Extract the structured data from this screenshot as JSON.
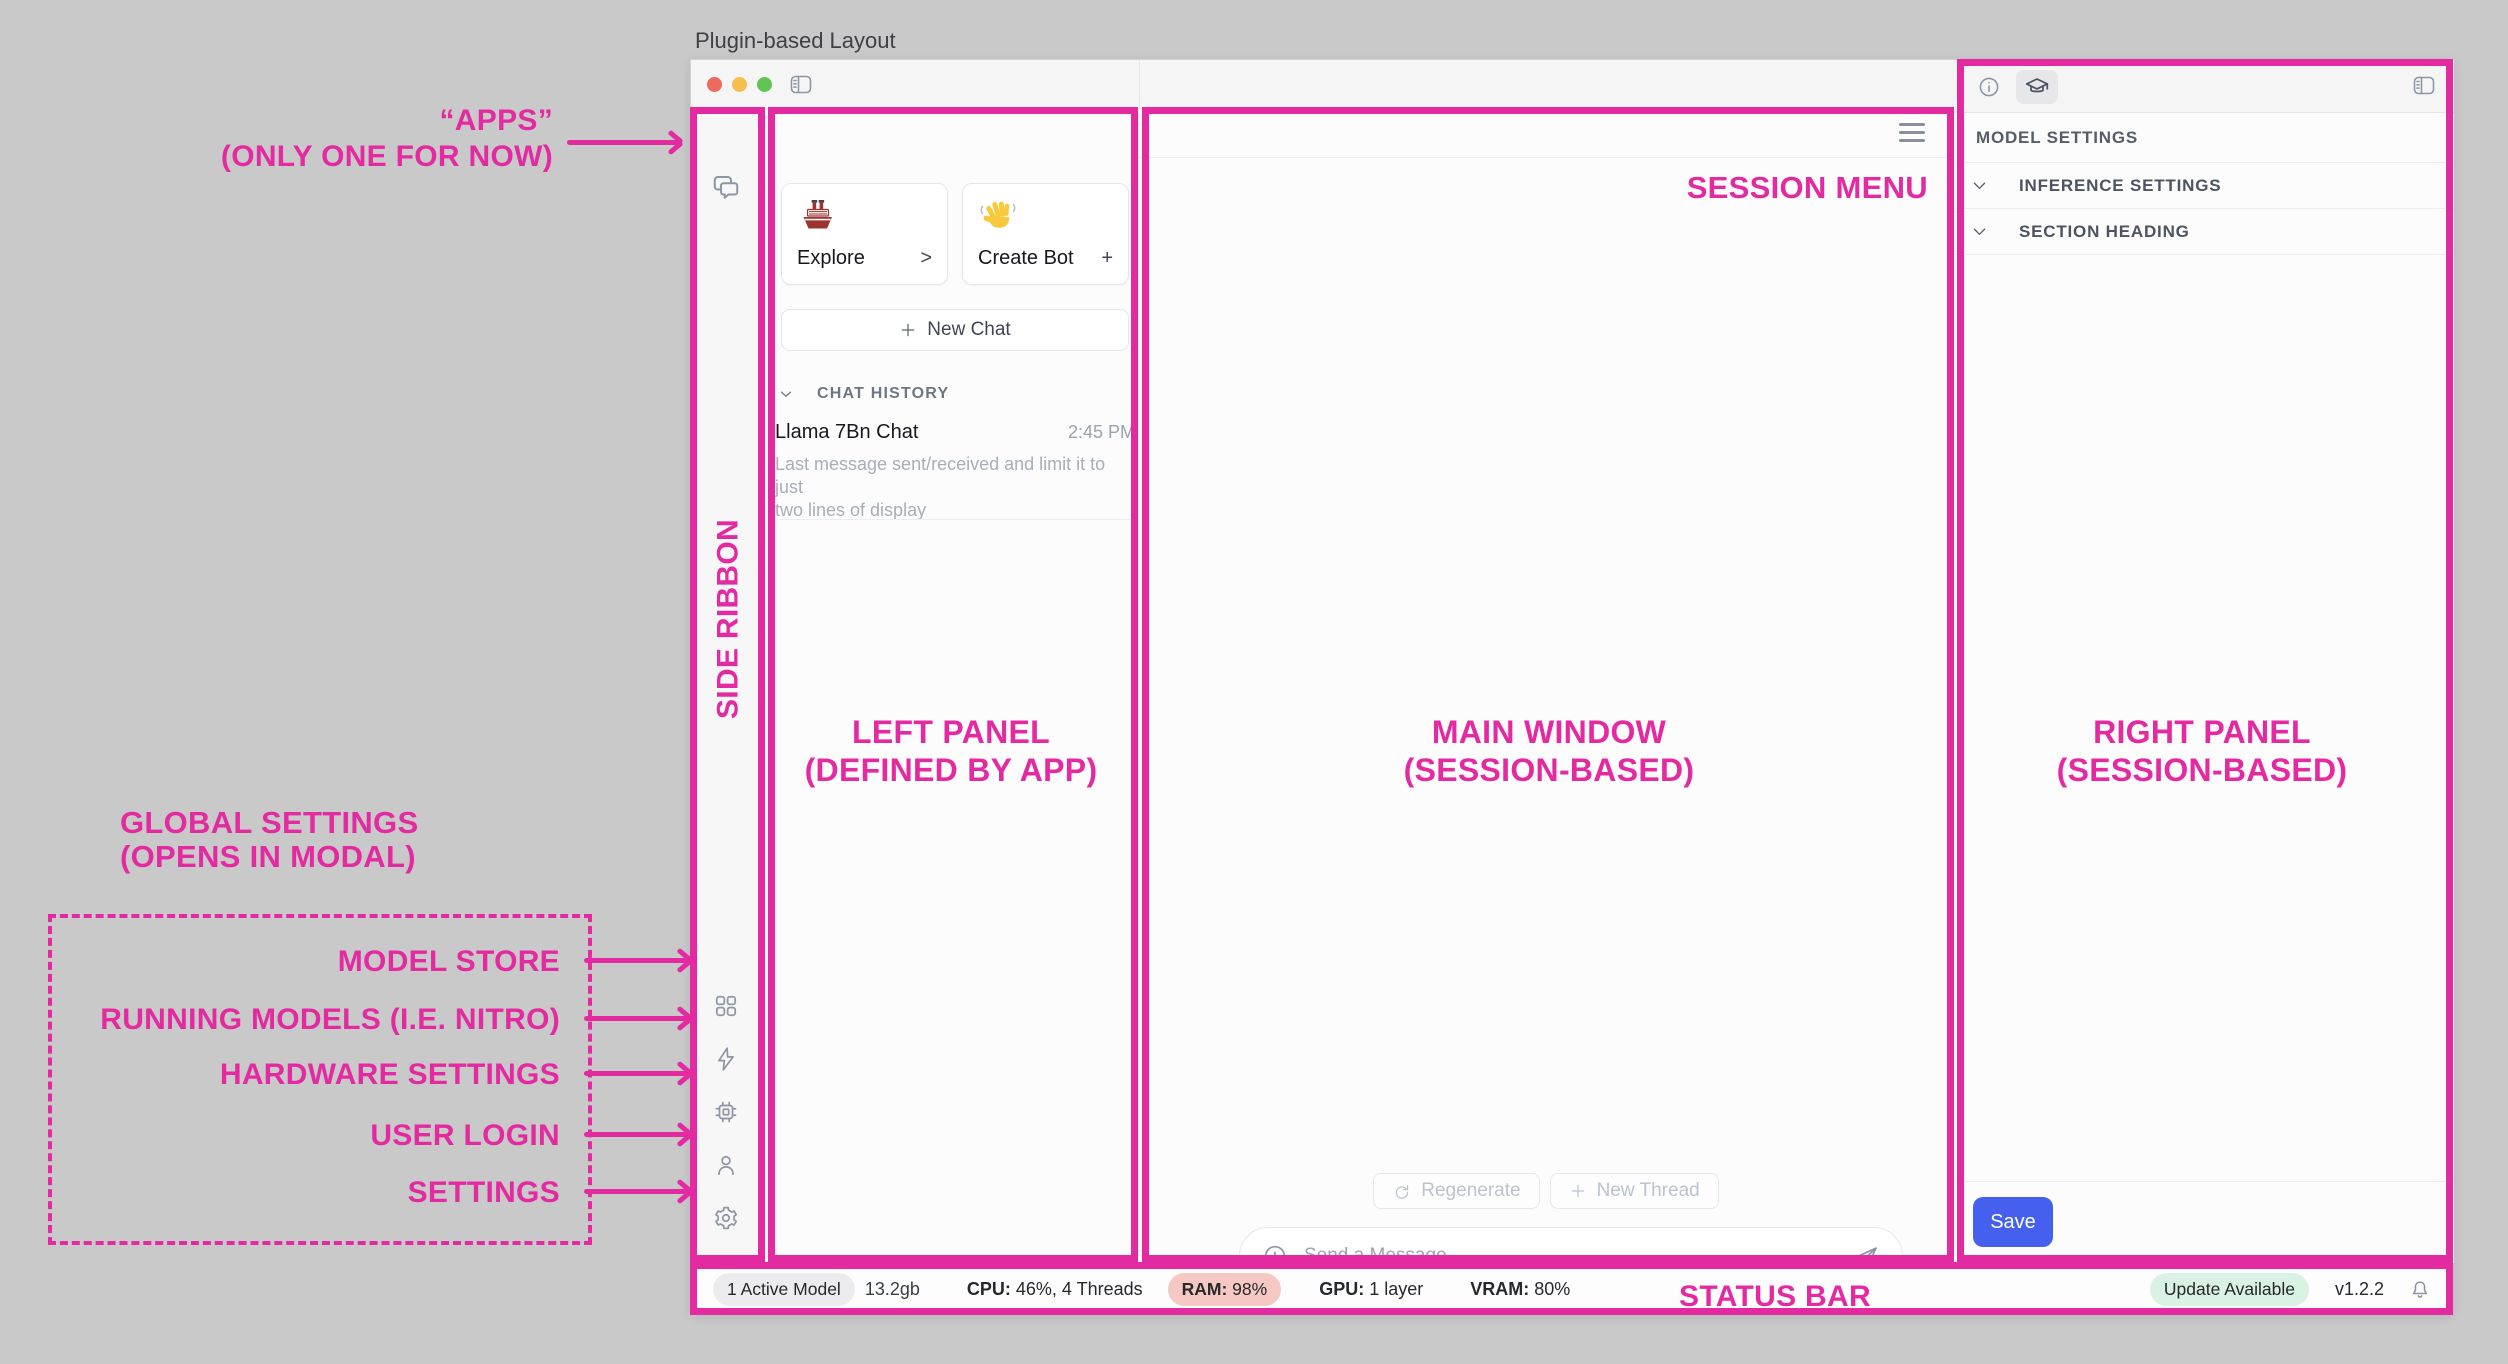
{
  "page_title": "Plugin-based Layout",
  "accent_color": "#e42aa1",
  "annotations": {
    "apps_line1": "“APPS”",
    "apps_line2": "(ONLY ONE FOR NOW)",
    "side_ribbon": "SIDE RIBBON",
    "left_panel_line1": "LEFT PANEL",
    "left_panel_line2": "(DEFINED BY APP)",
    "main_window_line1": "MAIN WINDOW",
    "main_window_line2": "(SESSION-BASED)",
    "right_panel_line1": "RIGHT PANEL",
    "right_panel_line2": "(SESSION-BASED)",
    "session_menu": "SESSION MENU",
    "status_bar": "STATUS BAR",
    "global_settings_line1": "GLOBAL SETTINGS",
    "global_settings_line2": "(OPENS IN MODAL)",
    "ribbon_targets": [
      "MODEL STORE",
      "RUNNING MODELS (I.E. NITRO)",
      "HARDWARE SETTINGS",
      "USER LOGIN",
      "SETTINGS"
    ]
  },
  "left_panel": {
    "explore_label": "Explore",
    "explore_accessory": ">",
    "create_bot_label": "Create Bot",
    "create_bot_accessory": "+",
    "new_chat_label": "New Chat",
    "chat_history_header": "CHAT HISTORY",
    "chat_item": {
      "title": "Llama 7Bn Chat",
      "time": "2:45 PM",
      "preview_line1": "Last message sent/received and limit it to just",
      "preview_line2": "two lines of display"
    }
  },
  "main": {
    "regenerate_label": "Regenerate",
    "new_thread_label": "New Thread",
    "message_placeholder": "Send a Message"
  },
  "right_panel": {
    "model_settings_header": "MODEL SETTINGS",
    "sections": [
      "INFERENCE SETTINGS",
      "SECTION HEADING"
    ],
    "save_label": "Save"
  },
  "status_bar": {
    "active_model": "1 Active Model",
    "memory": "13.2gb",
    "cpu_label": "CPU:",
    "cpu_value": " 46%, 4 Threads",
    "ram_label": "RAM:",
    "ram_value": " 98%",
    "gpu_label": "GPU:",
    "gpu_value": " 1 layer",
    "vram_label": "VRAM:",
    "vram_value": " 80%",
    "update_badge": "Update Available",
    "version": "v1.2.2"
  },
  "icons": {
    "chat-bubbles-icon": "apps ribbon tab",
    "grid-icon": "model store",
    "lightning-icon": "running models",
    "chip-icon": "hardware settings",
    "person-icon": "user login",
    "gear-icon": "settings",
    "wave-emoji": "👋",
    "ship-emoji": "🚢",
    "sidebar-toggle-icon": "collapse panel",
    "hamburger-icon": "session menu",
    "info-icon": "info tab",
    "graduation-cap-icon": "model settings tab",
    "refresh-icon": "regenerate",
    "plus-icon": "new",
    "plus-circle-icon": "attach",
    "send-icon": "send message",
    "chevron-down-icon": "expand section",
    "bell-icon": "notifications"
  }
}
